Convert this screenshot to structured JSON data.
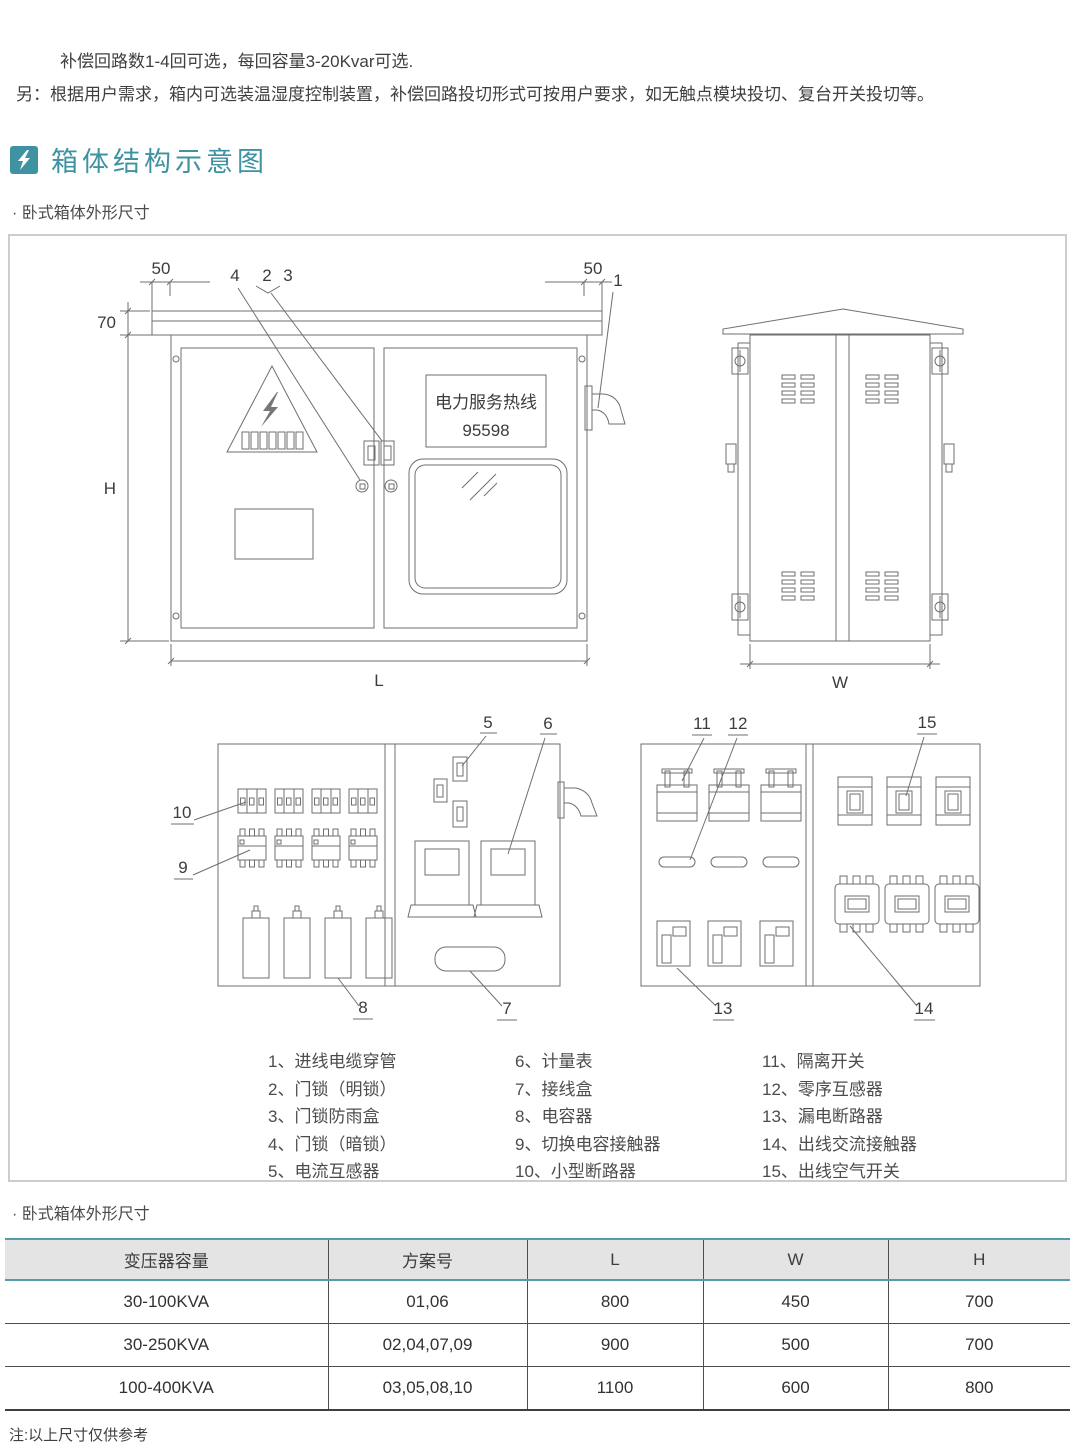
{
  "intro": {
    "line1": "补偿回路数1-4回可选，每回容量3-20Kvar可选.",
    "line2": "另：根据用户需求，箱内可选装温湿度控制装置，补偿回路投切形式可按用户要求，如无触点模块投切、复台开关投切等。"
  },
  "section_header": {
    "title": "箱体结构示意图"
  },
  "subtitle_top": "· 卧式箱体外形尺寸",
  "diagram": {
    "front_view": {
      "dim_left_overhang": "50",
      "dim_right_overhang": "50",
      "dim_roof_thickness": "70",
      "dim_height": "H",
      "dim_length": "L",
      "sign": {
        "line1": "电力服务热线",
        "line2": "95598"
      }
    },
    "side_view": {
      "dim_width": "W"
    },
    "callouts": {
      "c1": "1",
      "c2": "2",
      "c3": "3",
      "c4": "4",
      "c5": "5",
      "c6": "6",
      "c7": "7",
      "c8": "8",
      "c9": "9",
      "c10": "10",
      "c11": "11",
      "c12": "12",
      "c13": "13",
      "c14": "14",
      "c15": "15"
    }
  },
  "legend": {
    "col1": [
      "1、进线电缆穿管",
      "2、门锁（明锁）",
      "3、门锁防雨盒",
      "4、门锁（暗锁）",
      "5、电流互感器"
    ],
    "col2": [
      "6、计量表",
      "7、接线盒",
      "8、电容器",
      "9、切换电容接触器",
      "10、小型断路器"
    ],
    "col3": [
      "11、隔离开关",
      "12、零序互感器",
      "13、漏电断路器",
      "14、出线交流接触器",
      "15、出线空气开关"
    ]
  },
  "subtitle_table": "· 卧式箱体外形尺寸",
  "spec_table": {
    "headers": [
      "变压器容量",
      "方案号",
      "L",
      "W",
      "H"
    ],
    "rows": [
      {
        "capacity": "30-100KVA",
        "scheme": "01,06",
        "l": "800",
        "w": "450",
        "h": "700"
      },
      {
        "capacity": "30-250KVA",
        "scheme": "02,04,07,09",
        "l": "900",
        "w": "500",
        "h": "700"
      },
      {
        "capacity": "100-400KVA",
        "scheme": "03,05,08,10",
        "l": "1100",
        "w": "600",
        "h": "800"
      }
    ]
  },
  "note": "注:以上尺寸仅供参考",
  "colors": {
    "accent": "#3e92a1",
    "table_header_bg": "#e4e4e4",
    "diagram_line": "#6f6f6f"
  }
}
